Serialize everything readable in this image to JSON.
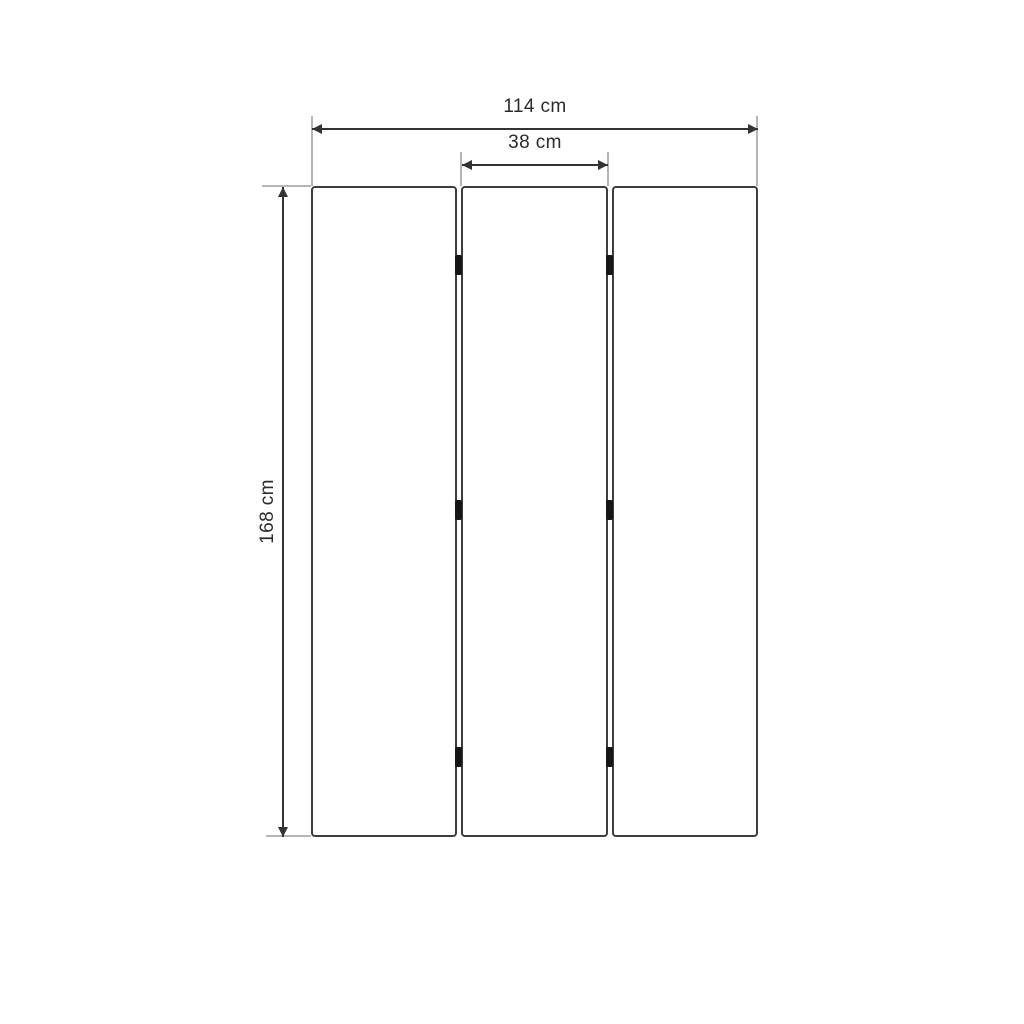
{
  "diagram": {
    "kind": "furniture-dimension-diagram",
    "subject": "three-panel folding screen, front view",
    "panels": {
      "count": 3,
      "hinge_rows_per_gap": 3
    },
    "dimensions": {
      "total_width": {
        "label": "114 cm",
        "value": 114,
        "unit": "cm"
      },
      "panel_width": {
        "label": "38 cm",
        "value": 38,
        "unit": "cm"
      },
      "height": {
        "label": "168 cm",
        "value": 168,
        "unit": "cm"
      }
    },
    "colors": {
      "background": "#ffffff",
      "panel_fill": "#ffffff",
      "panel_border": "#3d3d3d",
      "dimension_line": "#333333",
      "extension_line": "#b5b5b5",
      "hinge": "#161616",
      "label_text": "#2b2b2b"
    }
  }
}
